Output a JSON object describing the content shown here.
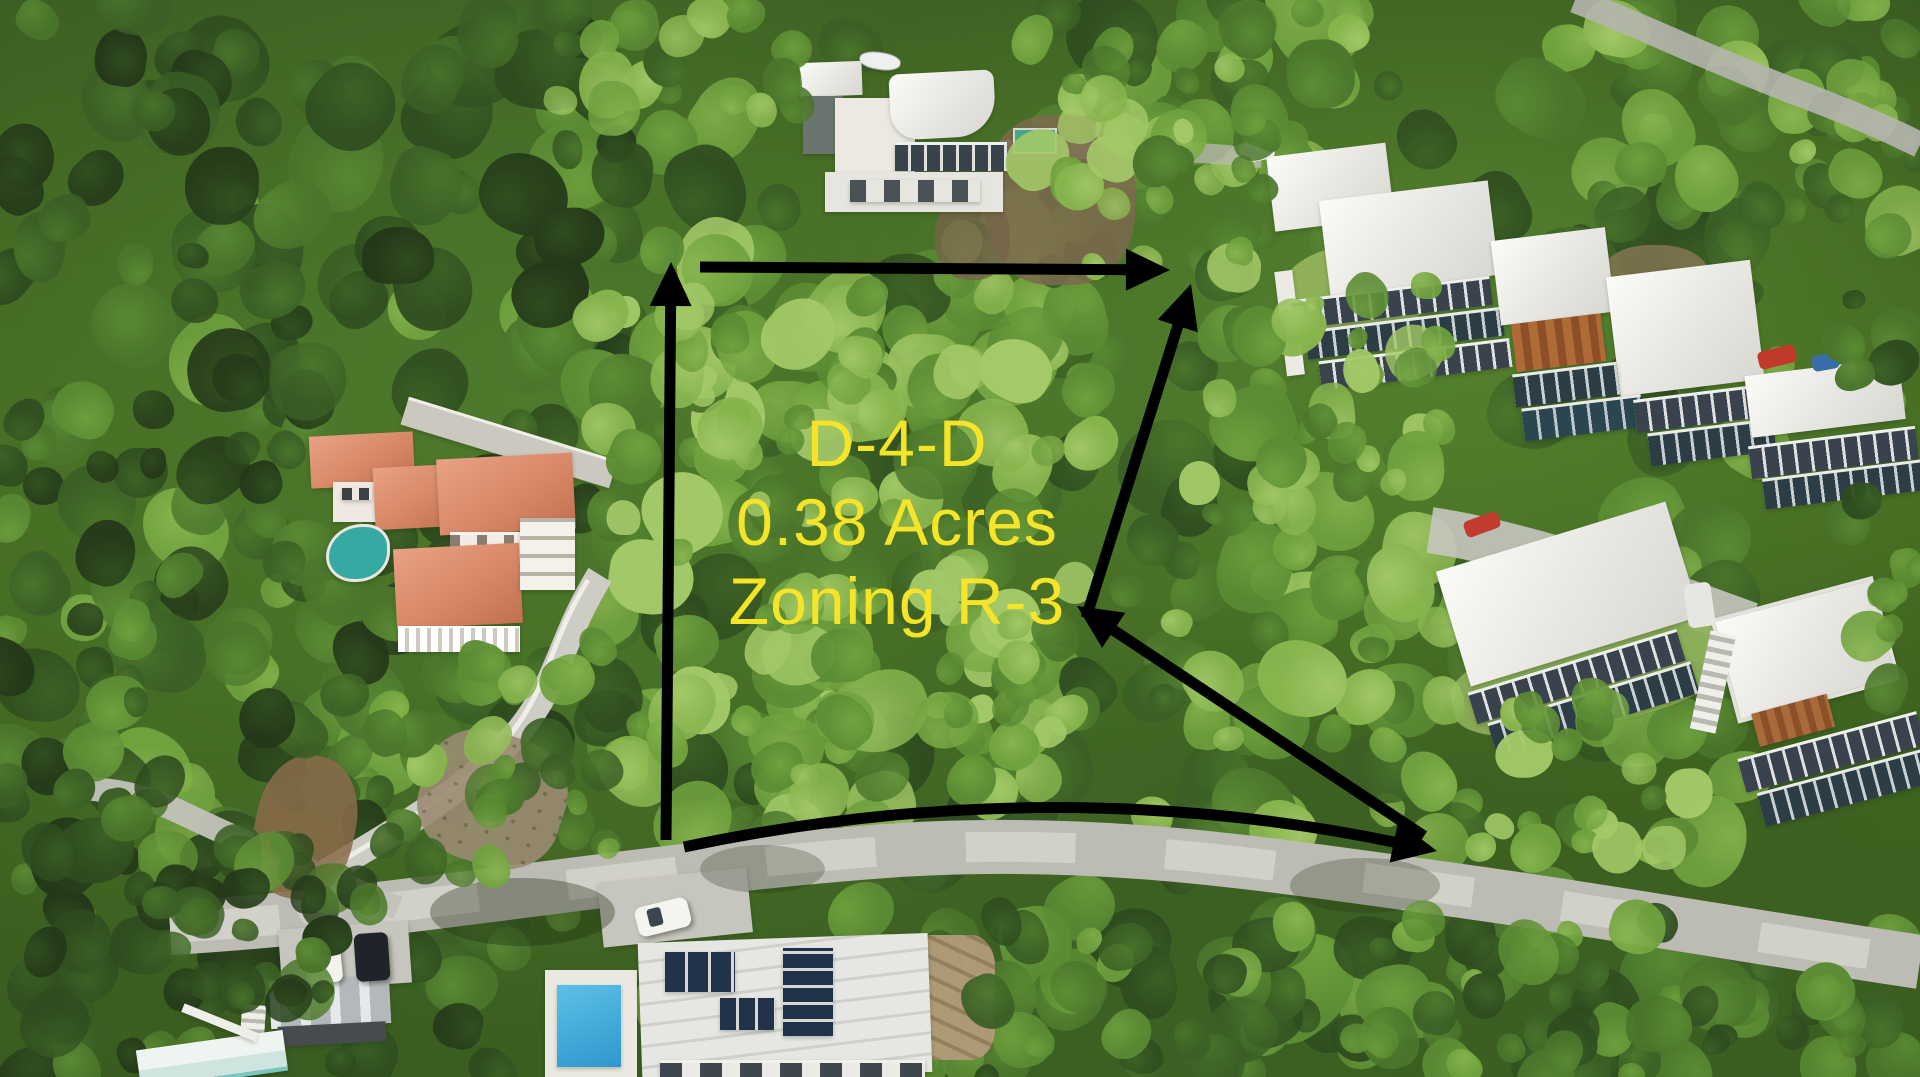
{
  "annotation": {
    "parcel_label": "D-4-D",
    "area_label": "0.38 Acres",
    "zoning_label": "Zoning R-3",
    "text_color": "#F6E428",
    "arrow_color": "#000000",
    "arrows": [
      {
        "name": "west-boundary-arrow",
        "type": "line",
        "x1": 666,
        "y1": 840,
        "x2": 671,
        "y2": 262
      },
      {
        "name": "north-boundary-arrow",
        "type": "line",
        "x1": 700,
        "y1": 267,
        "x2": 1170,
        "y2": 270
      },
      {
        "name": "east-boundary-arrow",
        "type": "line",
        "x1": 1086,
        "y1": 618,
        "x2": 1191,
        "y2": 284
      },
      {
        "name": "southeast-boundary-arrow",
        "type": "line",
        "x1": 1424,
        "y1": 836,
        "x2": 1077,
        "y2": 606
      },
      {
        "name": "road-frontage-arrow",
        "type": "quad",
        "x1": 684,
        "y1": 847,
        "cx": 1050,
        "cy": 770,
        "x2": 1437,
        "y2": 851
      }
    ]
  },
  "scene": {
    "colors": {
      "canopy_greens": [
        "#24391a",
        "#2f4c1f",
        "#3b5f25",
        "#4b762c",
        "#5c8c34",
        "#70a23e",
        "#88b54e",
        "#a4c968"
      ],
      "road_gray": "#bcbcb5",
      "driveway_gray": "#cdccc5",
      "roof_white": "#f2f1ec",
      "villa_roof_salmon": "#d98a70",
      "rust_roof": "#a8602f",
      "pool_teal": "#35a9a2",
      "pool_blue": "#36a6da",
      "dirt_brown": "#8a6b4a",
      "annotation_yellow": "#F6E428",
      "arrow_black": "#000000"
    }
  }
}
